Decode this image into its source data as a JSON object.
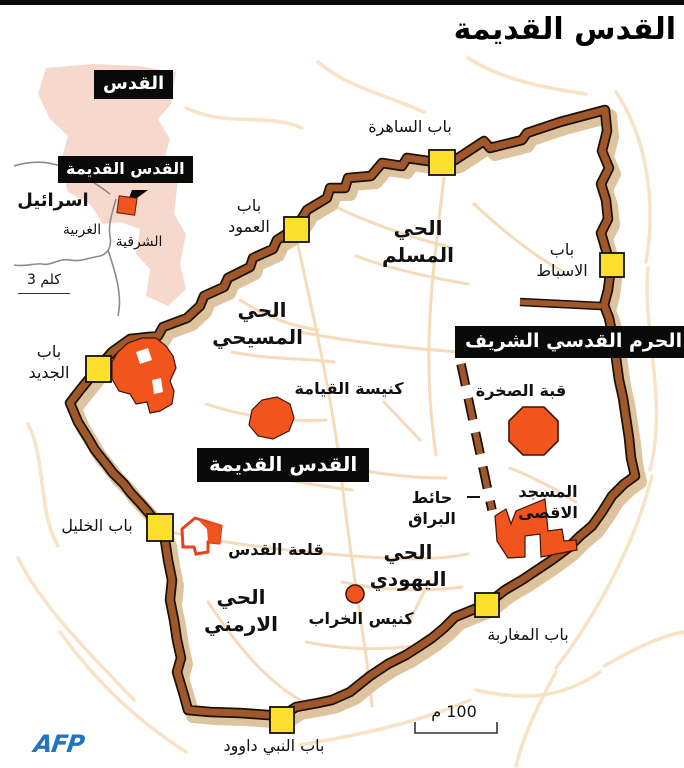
{
  "title": "القدس القديمة",
  "credit": "AFP",
  "inset": {
    "city_box": "القدس",
    "old_city_box": "القدس القديمة",
    "country": "اسرائيل",
    "west": "الغربية",
    "east": "الشرقية",
    "scale": "3 كلم"
  },
  "map": {
    "black_labels": {
      "haram": "الحرم القدسي الشريف",
      "old_city": "القدس القديمة"
    },
    "quarters": {
      "muslim": "الحي المسلم",
      "christian": "الحي المسيحي",
      "jewish": "الحي اليهودي",
      "armenian": "الحي الارمني"
    },
    "gates": {
      "herod": "باب الساهرة",
      "damascus": "باب العمود",
      "lions": "باب الاسباط",
      "new": "باب الجديد",
      "jaffa": "باب الخليل",
      "dung": "باب المغاربة",
      "zion": "باب النبي داوود"
    },
    "landmarks": {
      "holy_sepulchre": "كنيسة القيامة",
      "dome_of_rock": "قبة الصخرة",
      "aqsa": "المسجد الاقصى",
      "buraq_wall": "حائط البراق",
      "citadel": "قلعة القدس",
      "hurva": "كنيس الخراب"
    },
    "scale": "100 م"
  },
  "colors": {
    "wall_brown": "#a0572a",
    "wall_shadow": "#ddc49e",
    "wall_outline": "#1a1208",
    "gate_yellow": "#ffdf2e",
    "landmark_orange": "#f1551d",
    "street_outer": "#f9e2c6",
    "street_inner": "#f6dbbb",
    "inset_pink": "#f7d8cd",
    "afp_blue": "#2273c4"
  }
}
